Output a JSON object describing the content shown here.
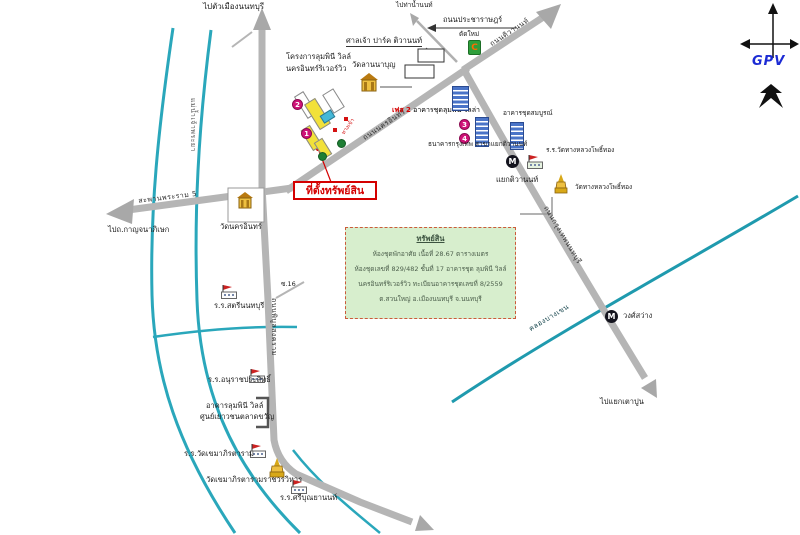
{
  "map": {
    "compass": {
      "brand": "GPV"
    },
    "info_box": {
      "title": "ทรัพย์สิน",
      "lines": [
        "ห้องชุดพักอาศัย เนื้อที่ 28.67 ตารางเมตร",
        "ห้องชุดเลขที่ 829/482 ชั้นที่ 17 อาคารชุด ลุมพินี วิลล์",
        "นครอินทร์ริเวอร์วิว ทะเบียนอาคารชุดเลขที่ 8/2559",
        "ต.สวนใหญ่ อ.เมืองนนทบุรี จ.นนทบุรี"
      ]
    },
    "property": {
      "location_label": "ที่ตั้งทรัพย์สิน",
      "project_name_line1": "โครงการลุมพินี วิลล์",
      "project_name_line2": "นครอินทร์ริเวอร์วิว",
      "phase_red": "เฟส 2",
      "phase_rest": "อาคารชุดลุมพินี วิลล่า",
      "entrance_label": "ทางเข้า",
      "marker1": "1",
      "marker2": "2",
      "marker3": "3",
      "marker4": "4"
    },
    "roads": {
      "nakhon_in": "ถนนนครอินทร์",
      "rama5_bridge": "สะพานพระราม 5",
      "tiwanon": "ถนนติวานนท์",
      "pracharat": "ถนนประชาราษฎร์",
      "pracharat_sub": "ตัดใหม่",
      "bangkok_nonthaburi": "ถนนกรุงเทพนนทบุรี",
      "phibun_songkhram": "ถนนพิบูลสงคราม",
      "soi_16": "ซ.16"
    },
    "directions": {
      "north_city": "ไปตัวเมืองนนทบุรี",
      "tha_nam_non": "ไปท่าน้ำนนท์",
      "kanchanaphisek": "ไปถ.กาญจนาภิเษก",
      "tao_pun": "ไปแยกเตาปูน"
    },
    "waterways": {
      "river": "แม่น้ำเจ้าพระยา",
      "canal": "คลองบางเขน"
    },
    "stations": [
      {
        "symbol": "M",
        "name": "แยกติวานนท์"
      },
      {
        "symbol": "M",
        "name": "วงศ์สว่าง"
      }
    ],
    "landmarks": {
      "shrine": "ศาลเจ้า ปาร์ค ติวานนท์",
      "wat_lanna_bun": "วัดลานนาบุญ",
      "store_c": "C",
      "condo_somboon": "อาคารชุดสมบูรณ์",
      "bank": "ธนาคารกรุงเทพ สาขาแยกติวานนท์",
      "school_thang_luang": "ร.ร.วัดทางหลวงโพธิ์ทอง",
      "wat_thang_luang": "วัดทางหลวงโพธิ์ทอง",
      "wat_nakhon_in": "วัดนครอินทร์",
      "school_satri": "ร.ร.สตรีนนทบุรี",
      "school_anurat": "ร.ร.อนุราชประสิทธิ์",
      "market_line1": "อาคารลุมพินี วิลล์",
      "market_line2": "ศูนย์เยาวชนตลาดขวัญ",
      "school_wat_khema": "ร.ร.วัดเขมาภิรตาราม",
      "wat_khema": "วัดเขมาภิรตารามราชวรวิหาร",
      "school_sriboonyanon": "ร.ร.ศรีบุณยานนท์"
    }
  }
}
